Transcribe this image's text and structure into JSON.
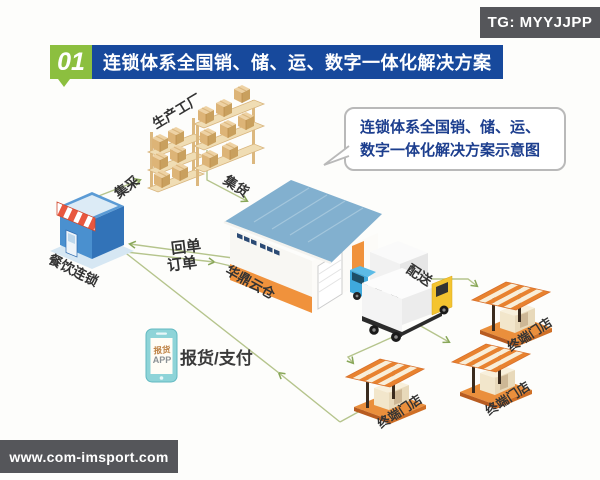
{
  "header": {
    "tg_badge": "TG: MYYJJPP",
    "section_number": "01",
    "title": "连锁体系全国销、储、运、数字一体化解决方案"
  },
  "callout": {
    "line1": "连锁体系全国销、储、运、",
    "line2": "数字一体化解决方案示意图"
  },
  "diagram": {
    "nodes": {
      "factory": "生产工厂",
      "restaurant_chain": "餐饮连锁",
      "warehouse": "华鼎云仓",
      "terminal_store_1": "终端门店",
      "terminal_store_2": "终端门店",
      "terminal_store_3": "终端门店",
      "app_line1": "报货",
      "app_line2": "APP"
    },
    "flows": {
      "procurement": "集采",
      "consolidation": "集货",
      "receipt": "回单",
      "order": "订单",
      "delivery": "配送",
      "report_pay": "报货/支付"
    }
  },
  "footer": {
    "watermark": "www.com-imsport.com"
  },
  "colors": {
    "title_green": "#8cbf3f",
    "title_blue": "#17499c",
    "badge_gray": "#55565a",
    "callout_text_blue": "#1c3e8e",
    "flow_line_green": "#b5c48c",
    "warehouse_orange": "#f0923c",
    "kiosk_orange": "#e8822f",
    "store_blue": "#4a90cf",
    "truck_cab_blue": "#3fa9dc",
    "truck_cab_yellow": "#f4c430",
    "phone_teal": "#8ed4d8"
  }
}
